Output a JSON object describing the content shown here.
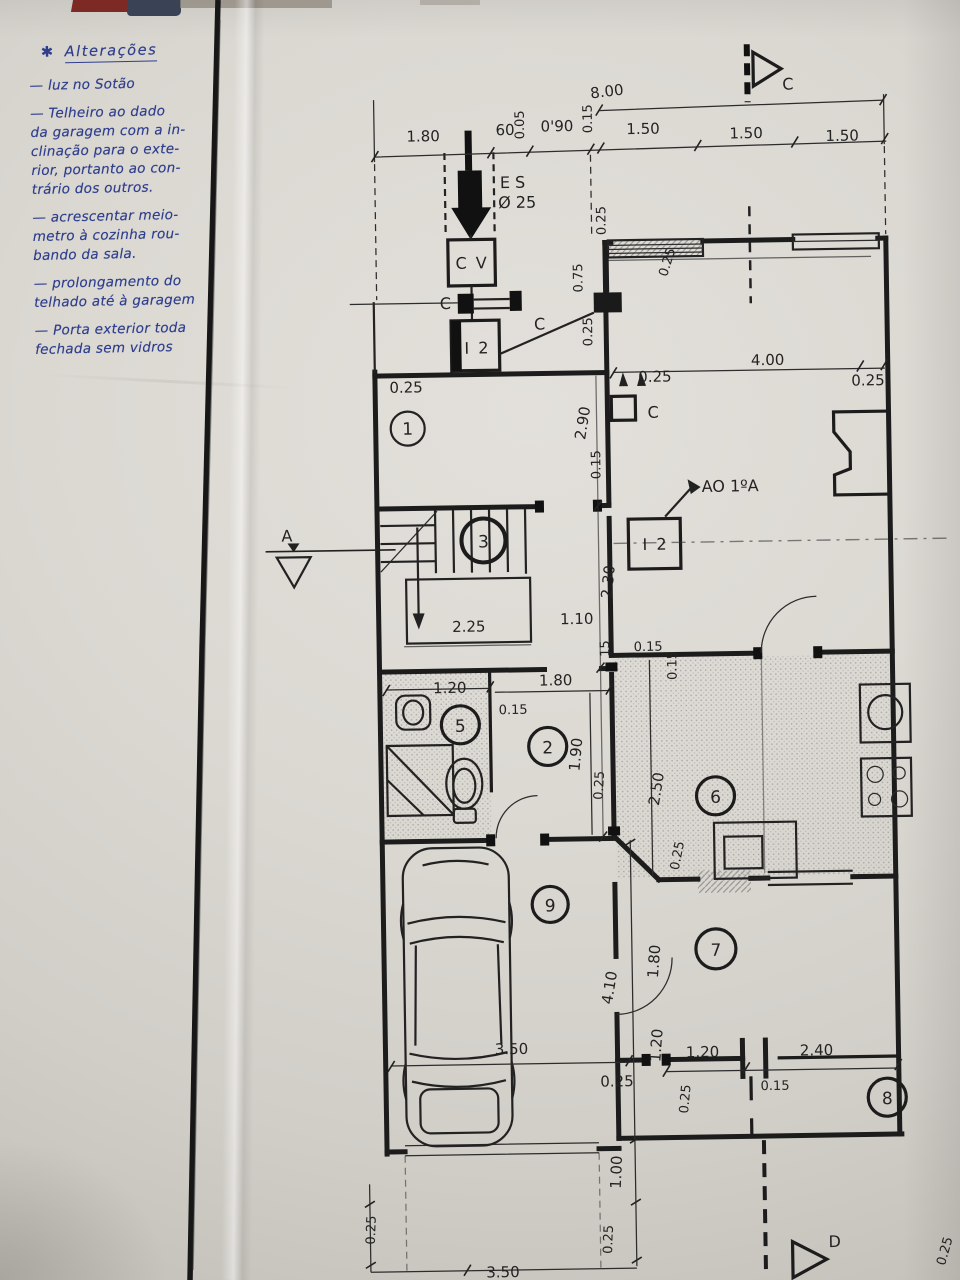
{
  "photo": {
    "paper_color": "#dbd8d2",
    "ink_color": "#2e3e8d",
    "plan_ink": "#1c1c1c"
  },
  "notes": {
    "star": "✱",
    "title": "Alterações",
    "lines": [
      "— luz no Sotão",
      "— Telheiro ao dado",
      "da garagem com a in-",
      "clinação para o exte-",
      "rior, portanto ao con-",
      "trário dos outros.",
      "— acrescentar meio-",
      "metro à cozinha rou-",
      "bando da sala.",
      "— prolongamento do",
      "telhado até à garagem",
      "— Porta exterior toda",
      "fechada sem vidros"
    ]
  },
  "plan": {
    "section_markers": {
      "top": "C",
      "left": "A",
      "bottom": "D"
    },
    "equipment": {
      "es": "E S",
      "es_size": "Ø 25",
      "cv": "C V",
      "i2_upper": "I 2",
      "i2_lower": "I 2",
      "c_conn": "C",
      "c_line": "C",
      "c_col": "C",
      "ao": "AO 1ºA"
    },
    "rooms": {
      "r1": "1",
      "r2": "2",
      "r3": "3",
      "r5": "5",
      "r6": "6",
      "r7": "7",
      "r8": "8",
      "r9": "9"
    },
    "dims": [
      "8.00",
      "1.80",
      "60",
      "0.05",
      "0'90",
      "0.15",
      "1.50",
      "1.50",
      "1.50",
      "0.25",
      "0.75",
      "0.25",
      "0.25",
      "0.25",
      "0.25",
      "4.00",
      "0.25",
      "2.90",
      "0.15",
      "2.30",
      "2.25",
      "1.10",
      "15",
      "0.15",
      "0.15",
      "1.20",
      "1.80",
      "0.15",
      "1.90",
      "0.25",
      "2.50",
      "0.25",
      "4.10",
      "3.50",
      "0.25",
      "1.80",
      "1.20",
      "1.20",
      "2.40",
      "0.15",
      "0.25",
      "1.00",
      "0.25",
      "0.25",
      "3.50",
      "0.25"
    ]
  }
}
